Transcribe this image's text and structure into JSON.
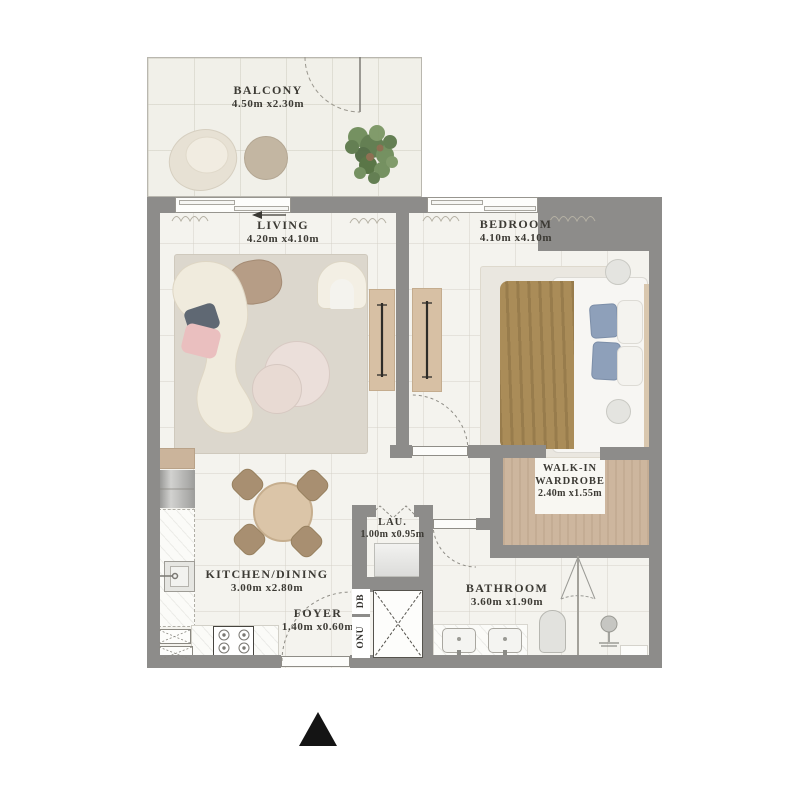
{
  "plan_title": "apartment-floor-plan",
  "rooms": [
    {
      "id": "balcony",
      "name": "BALCONY",
      "dims": "4.50m x2.30m"
    },
    {
      "id": "living",
      "name": "LIVING",
      "dims": "4.20m x4.10m"
    },
    {
      "id": "bedroom",
      "name": "BEDROOM",
      "dims": "4.10m x4.10m"
    },
    {
      "id": "walk_in_wardrobe",
      "name": "WALK-IN WARDROBE",
      "dims": "2.40m x1.55m"
    },
    {
      "id": "laundry",
      "name": "LAU.",
      "dims": "1.00m x0.95m"
    },
    {
      "id": "kitchen_dining",
      "name": "KITCHEN/DINING",
      "dims": "3.00m x2.80m"
    },
    {
      "id": "foyer",
      "name": "FOYER",
      "dims": "1.40m x0.60m"
    },
    {
      "id": "bathroom",
      "name": "BATHROOM",
      "dims": "3.60m x1.90m"
    }
  ],
  "annotations": {
    "db": "DB",
    "onu": "ONU"
  },
  "icons": {
    "north_arrow": "triangle-up"
  },
  "colors": {
    "wall": "#8d8c8a",
    "floor": "#f4f3ee",
    "balcony_floor": "#f1f0e9",
    "wood": "#cdb69e",
    "rug": "#dcd7cd",
    "sofa": "#f0ebdd",
    "blanket": "#aa8c58",
    "pillow_blue": "#8ea0ba",
    "pillow_pink": "#eabfbf",
    "plant_green": "#5d7a4c",
    "north_marker": "#141414"
  }
}
